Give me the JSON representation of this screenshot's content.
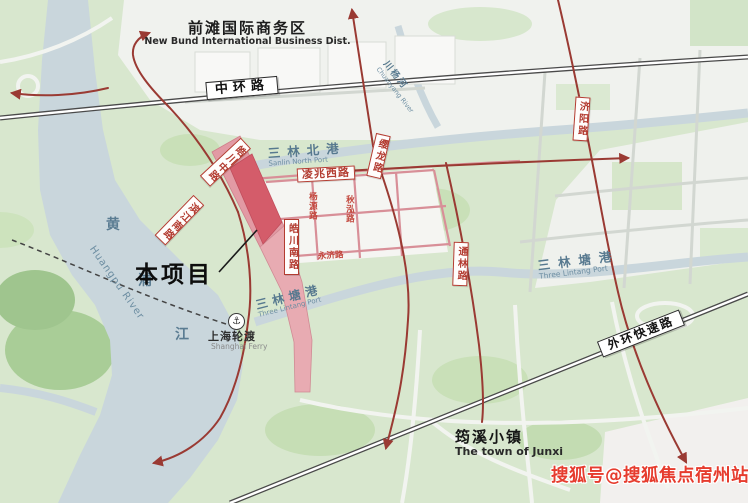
{
  "map": {
    "regions": {
      "new_bund": {
        "cn": "前滩国际商务区",
        "en": "New Bund International Business Dist."
      },
      "junxi": {
        "cn": "筠溪小镇",
        "en": "The town of Junxi"
      },
      "project": {
        "label": "本项目"
      },
      "ferry": {
        "cn": "上海轮渡",
        "en": "Shanghai Ferry",
        "icon_glyph": "⚓"
      }
    },
    "roads": {
      "zhonghuan": "中环路",
      "waihuan": "外环快速路",
      "lingzhao_xi": "凌兆西路",
      "haochuan_zhong": "皓川中路",
      "haochuan_nan": "皓川南路",
      "binjiang_nan": "滨江南路",
      "yinglong": "缨龙路",
      "tonglin": "通林路",
      "jiyang": "济阳路",
      "yangyuan": "杨源路",
      "qiuhong": "秋泓路",
      "yongji": "永济路"
    },
    "waters": {
      "huangpu": {
        "chars": [
          "黄",
          "浦",
          "江"
        ],
        "en": "Huangpu River"
      },
      "sanlin_north": {
        "cn": "三林北港",
        "en": "Sanlin North Port"
      },
      "sanlin_tang_center": {
        "cn": "三林塘港",
        "en": "Three Lintang Port"
      },
      "sanlin_tang_east": {
        "cn": "三林塘港",
        "en": "Three Lintang Port"
      },
      "chuanyang": {
        "cn": "川杨河",
        "en": "Chuanyang River"
      }
    },
    "watermark": "搜狐号@搜狐焦点宿州站",
    "colors": {
      "route_red": "#9a3a33",
      "road_pink": "#d88f98",
      "parcel_red": "#d45c6a",
      "corridor_pink": "#e29aa4",
      "water": "#c9d6dc",
      "green_base": "#d8e7ce",
      "label_red": "#b33c31",
      "water_text": "#57798f",
      "watermark_red": "#e63c2e"
    }
  }
}
